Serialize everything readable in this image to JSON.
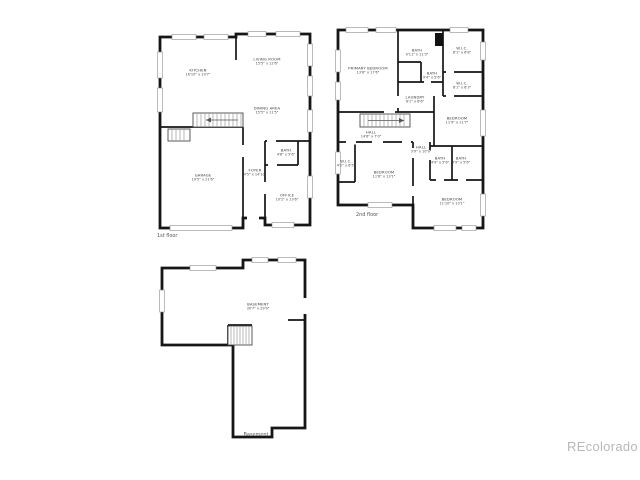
{
  "colors": {
    "background": "#ffffff",
    "walls": "#161616",
    "watermark": "#b8b8b8"
  },
  "watermark": {
    "text": "REcolorado"
  },
  "floors": {
    "first": {
      "caption": "1st floor",
      "rooms": {
        "kitchen": {
          "name": "KITCHEN",
          "dims": "16'10\" x 19'7\""
        },
        "living_room": {
          "name": "LIVING ROOM",
          "dims": "15'5\" x 12'6\""
        },
        "dining_area": {
          "name": "DINING AREA",
          "dims": "15'5\" x 11'5\""
        },
        "garage": {
          "name": "GARAGE",
          "dims": "19'5\" x 21'6\""
        },
        "foyer": {
          "name": "FOYER",
          "dims": "4'5\" x 14'10\""
        },
        "bath": {
          "name": "BATH",
          "dims": "4'8\" x 5'6\""
        },
        "office": {
          "name": "OFFICE",
          "dims": "10'2\" x 13'6\""
        }
      }
    },
    "second": {
      "caption": "2nd floor",
      "rooms": {
        "primary_bedroom": {
          "name": "PRIMARY BEDROOM",
          "dims": "13'8\" x 17'6\""
        },
        "bath_top": {
          "name": "BATH",
          "dims": "9'11\" x 11'3\""
        },
        "wic_top_right": {
          "name": "W.I.C.",
          "dims": "8'1\" x 6'8\""
        },
        "bath_middle": {
          "name": "BATH",
          "dims": "9'4\" x 5'6\""
        },
        "wic_middle": {
          "name": "W.I.C.",
          "dims": "6'1\" x 6'3\""
        },
        "laundry": {
          "name": "LAUNDRY",
          "dims": "6'1\" x 6'6\""
        },
        "bedroom_right": {
          "name": "BEDROOM",
          "dims": "11'9\" x 11'7\""
        },
        "hall": {
          "name": "HALL",
          "dims": "14'6\" x 7'0\""
        },
        "hall_small": {
          "name": "HALL",
          "dims": "3'9\" x 10'9\""
        },
        "wic_left": {
          "name": "W.I.C.",
          "dims": "4'2\" x 6'5\""
        },
        "bedroom_bottom_left": {
          "name": "BEDROOM",
          "dims": "11'8\" x 13'1\""
        },
        "bath_small_left": {
          "name": "BATH",
          "dims": "4'9\" x 5'6\""
        },
        "bath_small_right": {
          "name": "BATH",
          "dims": "4'9\" x 5'6\""
        },
        "bedroom_bottom_right": {
          "name": "BEDROOM",
          "dims": "11'10\" x 13'1\""
        }
      }
    },
    "basement": {
      "caption": "Basement",
      "rooms": {
        "basement": {
          "name": "BASEMENT",
          "dims": "30'7\" x 29'9\""
        }
      }
    }
  }
}
